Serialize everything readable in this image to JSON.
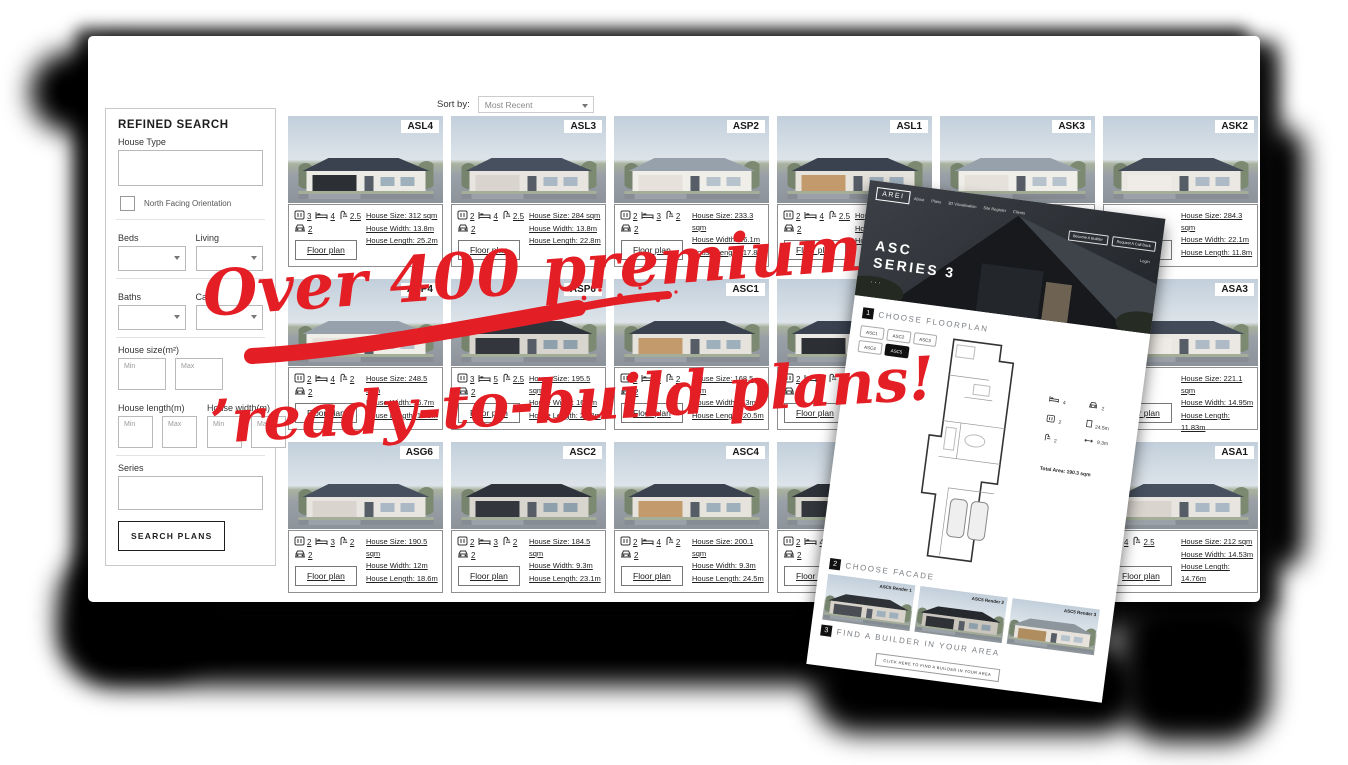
{
  "annotation": {
    "line1": "Over 400 premium",
    "line2": "’ready-to-build plans!",
    "color": "#e41e25"
  },
  "sort": {
    "label": "Sort by:",
    "value": "Most Recent"
  },
  "sidebar": {
    "title": "REFINED SEARCH",
    "house_type_label": "House Type",
    "north_facing_label": "North Facing Orientation",
    "beds_label": "Beds",
    "living_label": "Living",
    "baths_label": "Baths",
    "cars_label": "Cars",
    "house_size_label": "House size(m²)",
    "house_length_label": "House length(m)",
    "house_width_label": "House width(m)",
    "min_placeholder": "Min",
    "max_placeholder": "Max",
    "series_label": "Series",
    "search_button": "SEARCH PLANS"
  },
  "card_labels": {
    "size": "House Size:",
    "width": "House Width:",
    "length": "House Length:",
    "floorplan_button": "Floor plan"
  },
  "cards": [
    {
      "code": "ASL4",
      "shower": "3",
      "bed": "4",
      "bath": "2.5",
      "car": "2",
      "size": "312 sqm",
      "width": "13.8m",
      "length": "25.2m"
    },
    {
      "code": "ASL3",
      "shower": "2",
      "bed": "4",
      "bath": "2.5",
      "car": "2",
      "size": "284 sqm",
      "width": "13.8m",
      "length": "22.8m"
    },
    {
      "code": "ASP2",
      "shower": "2",
      "bed": "3",
      "bath": "2",
      "car": "2",
      "size": "233.3 sqm",
      "width": "16.1m",
      "length": "17.8m"
    },
    {
      "code": "ASL1",
      "shower": "2",
      "bed": "4",
      "bath": "2.5",
      "car": "2",
      "size": "2",
      "width": "",
      "length": ""
    },
    {
      "code": "ASK3",
      "shower": "",
      "bed": "",
      "bath": "",
      "car": "",
      "size": "",
      "width": "",
      "length": ""
    },
    {
      "code": "ASK2",
      "shower": "",
      "bed": "",
      "bath": "",
      "car": "",
      "size": "284.3 sqm",
      "width": "22.1m",
      "length": "11.8m"
    },
    {
      "code": "ASP4",
      "shower": "2",
      "bed": "4",
      "bath": "2",
      "car": "2",
      "size": "248.5 sqm",
      "width": "16.7m",
      "length": "17.8m"
    },
    {
      "code": "ASP6",
      "shower": "3",
      "bed": "5",
      "bath": "2.5",
      "car": "2",
      "size": "195.5 sqm",
      "width": "16.7m",
      "length": "20.8m"
    },
    {
      "code": "ASC1",
      "shower": "1",
      "bed": "3",
      "bath": "2",
      "car": "2",
      "size": "168.5 sqm",
      "width": "9.3m",
      "length": "20.5m"
    },
    {
      "code": "",
      "shower": "2",
      "bed": "4",
      "bath": "2",
      "car": "2",
      "size": "",
      "width": "",
      "length": ""
    },
    {
      "code": "",
      "shower": "",
      "bed": "",
      "bath": "",
      "car": "",
      "size": "",
      "width": "",
      "length": ""
    },
    {
      "code": "ASA3",
      "shower": "",
      "bed": "",
      "bath": "2",
      "car": "",
      "size": "221.1 sqm",
      "width": "14.95m",
      "length": "11.83m"
    },
    {
      "code": "ASG6",
      "shower": "2",
      "bed": "3",
      "bath": "2",
      "car": "2",
      "size": "190.5 sqm",
      "width": "12m",
      "length": "18.6m"
    },
    {
      "code": "ASC2",
      "shower": "2",
      "bed": "3",
      "bath": "2",
      "car": "2",
      "size": "184.5 sqm",
      "width": "9.3m",
      "length": "23.1m"
    },
    {
      "code": "ASC4",
      "shower": "2",
      "bed": "4",
      "bath": "2",
      "car": "2",
      "size": "200.1 sqm",
      "width": "9.3m",
      "length": "24.5m"
    },
    {
      "code": "",
      "shower": "2",
      "bed": "4",
      "bath": "2",
      "car": "2",
      "size": "",
      "width": "",
      "length": ""
    },
    {
      "code": "",
      "shower": "",
      "bed": "",
      "bath": "",
      "car": "",
      "size": "",
      "width": "",
      "length": ""
    },
    {
      "code": "ASA1",
      "shower": "",
      "bed": "4",
      "bath": "2.5",
      "car": "",
      "size": "212 sqm",
      "width": "14.53m",
      "length": "14.76m"
    }
  ],
  "overlay": {
    "logo": "AREI",
    "nav": [
      "About",
      "Plans",
      "3D Visualisation",
      "Site Register",
      "Clients"
    ],
    "header_buttons": [
      "Become A Builder",
      "Request A Call Back"
    ],
    "login_label": "Login",
    "hero_title": "ASC",
    "hero_subtitle": "SERIES 3",
    "sections": [
      {
        "num": "1",
        "title": "CHOOSE FLOORPLAN"
      },
      {
        "num": "2",
        "title": "CHOOSE FACADE"
      },
      {
        "num": "3",
        "title": "FIND A BUILDER IN YOUR AREA"
      }
    ],
    "floorplan_options": [
      "ASC1",
      "ASC2",
      "ASC3",
      "ASC4",
      "ASC5"
    ],
    "selected_floorplan": "ASC5",
    "plan_stats": [
      {
        "icon": "bed",
        "value": "4"
      },
      {
        "icon": "car",
        "value": "2"
      },
      {
        "icon": "shower",
        "value": "2"
      },
      {
        "icon": "length",
        "value": "24.5m"
      },
      {
        "icon": "bath",
        "value": "2"
      },
      {
        "icon": "width",
        "value": "9.3m"
      }
    ],
    "total_area_label": "Total Area:",
    "total_area_value": "190.3 sqm",
    "facades": [
      "ASC5 Render 1",
      "ASC5 Render 2",
      "ASC5 Render 3"
    ],
    "builder_button": "CLICK HERE TO FIND A BUILDER IN YOUR AREA"
  }
}
